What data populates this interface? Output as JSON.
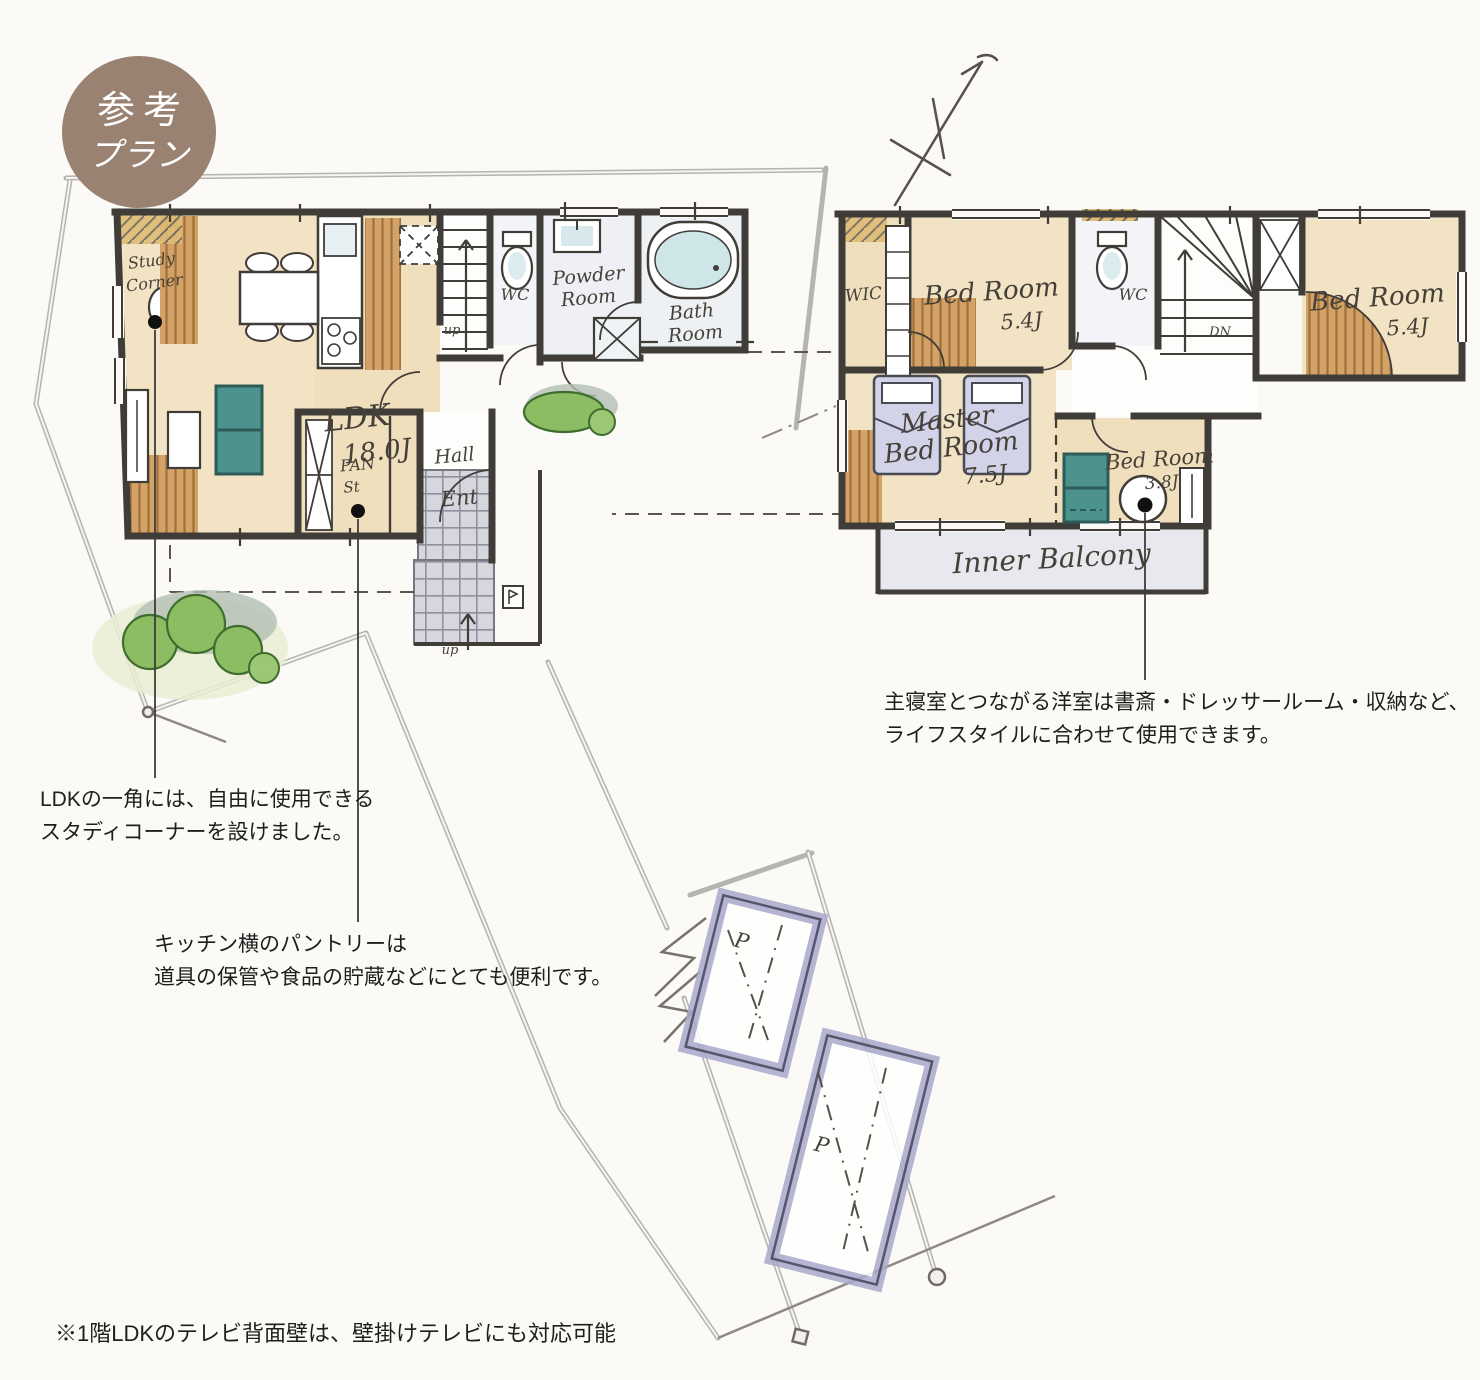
{
  "badge": {
    "line1": "参考",
    "line2": "プラン"
  },
  "floor1": {
    "labels": {
      "study_line1": "Study",
      "study_line2": "Corner",
      "ldk": "LDK",
      "ldk_size": "18.0J",
      "wc": "WC",
      "powder_line1": "Powder",
      "powder_line2": "Room",
      "bath_line1": "Bath",
      "bath_line2": "Room",
      "pantry": "PAN",
      "pantry_st": "St",
      "hall": "Hall",
      "entrance": "Ent",
      "up": "up"
    }
  },
  "floor2": {
    "labels": {
      "wic": "WIC",
      "bed_room": "Bed Room",
      "bed1_size": "5.4J",
      "bed2_size": "5.4J",
      "bed3_size": "3.8J",
      "wc": "WC",
      "down": "DN",
      "master_line1": "Master",
      "master_line2": "Bed Room",
      "master_size": "7.5J",
      "balcony": "Inner Balcony"
    }
  },
  "site": {
    "parking_label": "P"
  },
  "annotations": {
    "study": {
      "line1": "LDKの一角には、自由に使用できる",
      "line2": "スタディコーナーを設けました。"
    },
    "pantry": {
      "line1": "キッチン横のパントリーは",
      "line2": "道具の保管や食品の貯蔵などにとても便利です。"
    },
    "bedroom": {
      "line1": "主寝室とつながる洋室は書斎・ドレッサールーム・収納など、",
      "line2": "ライフスタイルに合わせて使用できます。"
    }
  },
  "footnote": {
    "text": "※1階LDKのテレビ背面壁は、壁掛けテレビにも対応可能"
  },
  "colors": {
    "badge": "#9a8272",
    "accent_teal": "#4d938d",
    "floor_beige": "#f2e3c5",
    "wood": "#d3a266",
    "parking": "#9f9fc7"
  }
}
